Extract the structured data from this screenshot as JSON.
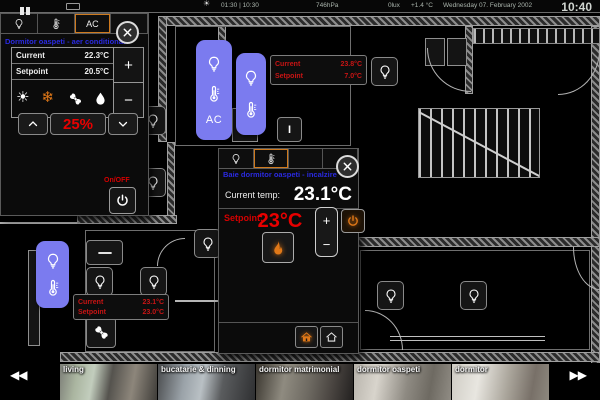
{
  "statusbar": {
    "sun_times": "01:30 | 10:30",
    "pressure": "746hPa",
    "lux": "0lux",
    "outside_temp": "+1.4 °C",
    "date": "Wednesday 07. February 2002",
    "clock": "10:40"
  },
  "ac_panel": {
    "tab_label": "AC",
    "title": "Dormitor oaspeti - aer conditionat",
    "current_label": "Current",
    "current_value": "22.3°C",
    "setpoint_label": "Setpoint",
    "setpoint_value": "20.5°C",
    "plus": "+",
    "minus": "−",
    "fan_speed": "25%",
    "onoff_label": "On/OFF"
  },
  "heating_panel": {
    "title": "Baie dormitor oaspeti - incalzire",
    "current_label": "Current temp:",
    "current_value": "23.1°C",
    "setpoint_label": "Setpoint:",
    "setpoint_value": "23°C",
    "plus": "+",
    "minus": "−"
  },
  "room_info_top": {
    "current_label": "Current",
    "current_value": "23.8°C",
    "setpoint_label": "Setpoint",
    "setpoint_value": "7.0°C"
  },
  "room_info_left": {
    "current_label": "Current",
    "current_value": "23.1°C",
    "setpoint_label": "Setpoint",
    "setpoint_value": "23.0°C"
  },
  "plan_buttons": {
    "ac_room_label": "AC",
    "switch_on_label": "I"
  },
  "camera_strip": {
    "prev": "◀◀",
    "next": "▶▶",
    "cameras": [
      {
        "label": "living"
      },
      {
        "label": "bucatarie & dinning"
      },
      {
        "label": "dormitor matrimonial"
      },
      {
        "label": "dormitor oaspeti"
      },
      {
        "label": "dormitor"
      }
    ]
  },
  "icons": {
    "bulb": "light-bulb",
    "thermo": "thermometer",
    "sun": "sun (heat mode)",
    "snow": "snowflake (cool mode)",
    "fan": "fan",
    "drop": "water-drop (dry mode)",
    "flame": "flame (heating on)",
    "power": "power",
    "house_filled": "house filled (comfort mode)",
    "house_open": "house outline (eco mode)",
    "close": "close x",
    "pause": "pause"
  },
  "colors": {
    "accent_orange": "#e07818",
    "alert_red": "#cc0000",
    "title_blue": "#2a2ae0",
    "room_button_purple": "#7b7bef"
  }
}
